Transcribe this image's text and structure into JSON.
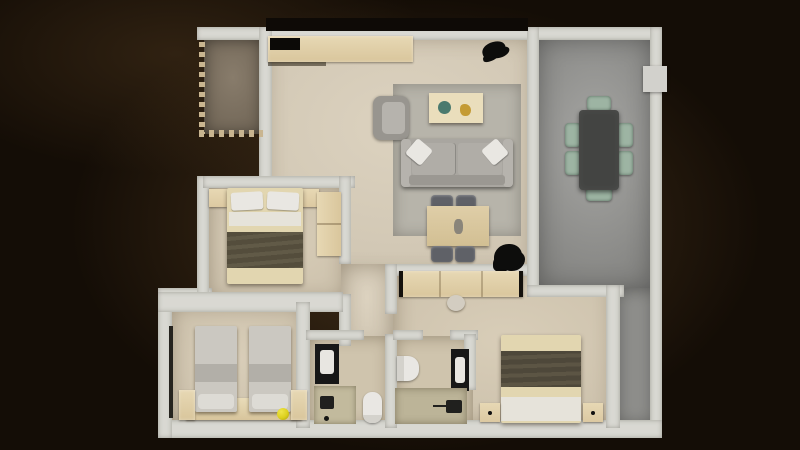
{
  "meta": {
    "description": "Photorealistic top-down 3D render of an apartment floor plan, light beige marble floors and white walls, surrounded by a dark brown vignette background",
    "canvas": {
      "width": 800,
      "height": 450
    }
  },
  "palette": {
    "bg": "#140d06",
    "glow": "#8e6739",
    "wall": "#d9d8d2",
    "wallDim": "#0e0a06",
    "railing": "#c9b590",
    "floorLiving": "#d8cdb8",
    "floorBedroom": "#d5c9b2",
    "floorBath": "#cfc4ad",
    "floorGray": "#9c9c99",
    "floorGrayStrip": "#8f8f8c",
    "floorBalcony": "#7f7260",
    "rug": "#b7b4aa",
    "wood": "#e7d8b4",
    "deskWood": "#dfcea8",
    "tableWood": "#eadebc",
    "sofa": "#a9a6a0",
    "sofaLight": "#b6b3ad",
    "cushion": "#b0ada7",
    "pillowWhite": "#e9e7e2",
    "armchair": "#98958f",
    "bowlTeal": "#4a7a6e",
    "decorGold": "#c49b35",
    "chairDark": "#5f6167",
    "plantBlack": "#0d0d0c",
    "diningTable": "#434442",
    "chairSage": "#9db4a3",
    "acUnit": "#d2d1cc",
    "blanketBeige": "#e2d6b0",
    "throwDark": "#544d3c",
    "sheetWhite": "#e6e3da",
    "twinTop": "#cbc8c1",
    "twinBand": "#b2afa8",
    "twinPillow": "#dddbd5",
    "ballYellow": "#ddd01d",
    "vanityBlack": "#171717",
    "sinkWhite": "#e8e6e1",
    "toiletWhite": "#e9e7e3",
    "showerFloor": "#c2ba9d",
    "fixtureBlack": "#20201e",
    "sliderDark": "#26241f"
  },
  "rooms": [
    {
      "id": "living-room",
      "name": "Living room with rug, sofa, armchair, coffee table and desk"
    },
    {
      "id": "dining-terrace",
      "name": "Gray-floor dining terrace with table for six"
    },
    {
      "id": "balcony",
      "name": "Small balcony with dashed railing, top left"
    },
    {
      "id": "bedroom-double-left",
      "name": "Bedroom with double bed and wardrobe, middle left"
    },
    {
      "id": "bedroom-twin",
      "name": "Bedroom with two twin beds, bottom left"
    },
    {
      "id": "bedroom-master",
      "name": "Master bedroom with double bed, bottom right"
    },
    {
      "id": "bathroom-center",
      "name": "Bathroom with vanity, shower and toilet, bottom center"
    },
    {
      "id": "bathroom-ensuite",
      "name": "En-suite bathroom with toilet, vanity and shower"
    },
    {
      "id": "corridor",
      "name": "Hallway connecting living room, bathrooms and bedrooms"
    }
  ],
  "furniture": [
    {
      "id": "console-sideboard",
      "room": "living-room",
      "name": "Long light-wood sideboard along top wall with black open shelf"
    },
    {
      "id": "entry-object",
      "room": "living-room",
      "name": "Small black object near entrance"
    },
    {
      "id": "area-rug",
      "room": "living-room",
      "name": "Gray area rug"
    },
    {
      "id": "armchair",
      "room": "living-room",
      "name": "Gray armchair"
    },
    {
      "id": "coffee-table",
      "room": "living-room",
      "name": "Light wood coffee table with teal bowl and gold decor"
    },
    {
      "id": "sofa",
      "room": "living-room",
      "name": "Gray three-seat sofa with two light pillows"
    },
    {
      "id": "desk",
      "room": "living-room",
      "name": "Wood desk with four dark chairs"
    },
    {
      "id": "plant",
      "room": "living-room",
      "name": "Black potted plant silhouette"
    },
    {
      "id": "dining-table",
      "room": "dining-terrace",
      "name": "Dark rectangular dining table"
    },
    {
      "id": "dining-chairs",
      "room": "dining-terrace",
      "name": "Six sage-green chairs"
    },
    {
      "id": "ac-unit",
      "room": "dining-terrace",
      "name": "White wall-mounted unit, top right"
    },
    {
      "id": "double-bed-left",
      "room": "bedroom-double-left",
      "name": "Double bed, white pillows, beige blanket, dark throw"
    },
    {
      "id": "nightstands-left",
      "room": "bedroom-double-left",
      "name": "Two wood nightstands"
    },
    {
      "id": "wardrobe-left",
      "room": "bedroom-double-left",
      "name": "Wood wardrobe on right wall"
    },
    {
      "id": "twin-beds",
      "room": "bedroom-twin",
      "name": "Two twin beds with light gray bedding"
    },
    {
      "id": "twin-headboard",
      "room": "bedroom-twin",
      "name": "Wood headboard bench along bottom wall"
    },
    {
      "id": "yellow-ball",
      "room": "bedroom-twin",
      "name": "Small yellow ball on floor"
    },
    {
      "id": "slider-track",
      "room": "bedroom-twin",
      "name": "Dark sliding-door track on left wall"
    },
    {
      "id": "master-bed",
      "room": "bedroom-master",
      "name": "Double bed with dark throw and white sheets"
    },
    {
      "id": "master-nightstands",
      "room": "bedroom-master",
      "name": "Two wood nightstands with dark knobs"
    },
    {
      "id": "master-wardrobe",
      "room": "bedroom-master",
      "name": "Long wood wardrobe along top wall"
    },
    {
      "id": "pouf",
      "room": "bedroom-master",
      "name": "Small round pouf"
    },
    {
      "id": "vanity-center",
      "room": "bathroom-center",
      "name": "Black vanity with white sink"
    },
    {
      "id": "shower-center",
      "room": "bathroom-center",
      "name": "Shower area with black fixture"
    },
    {
      "id": "toilet-center",
      "room": "bathroom-center",
      "name": "White toilet"
    },
    {
      "id": "toilet-ensuite",
      "room": "bathroom-ensuite",
      "name": "White toilet on left wall"
    },
    {
      "id": "vanity-ensuite",
      "room": "bathroom-ensuite",
      "name": "Black vanity with white sink"
    },
    {
      "id": "shower-ensuite",
      "room": "bathroom-ensuite",
      "name": "Shower area with black fixture"
    }
  ]
}
